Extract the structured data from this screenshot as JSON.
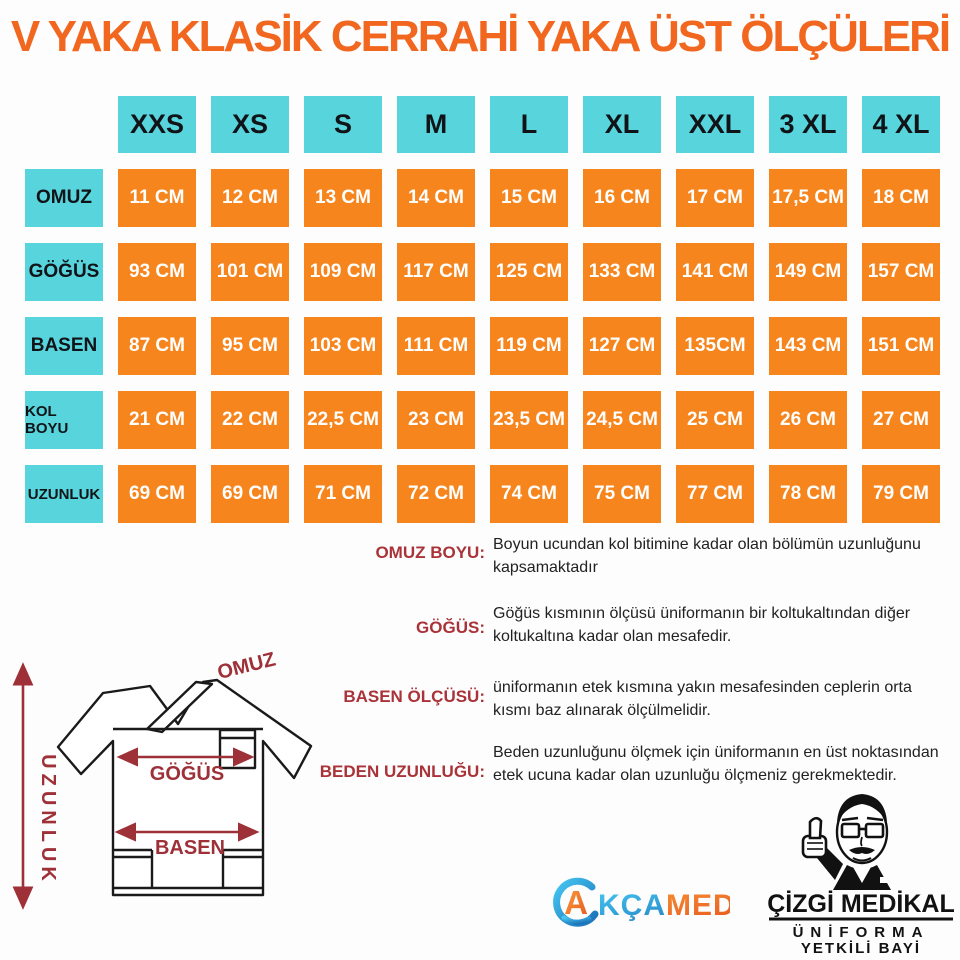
{
  "title": "V YAKA KLASİK CERRAHİ YAKA ÜST ÖLÇÜLERİ",
  "colors": {
    "title_orange": "#f2671f",
    "cell_orange": "#f6851d",
    "header_cyan": "#57d4dc",
    "label_red": "#a93338",
    "diagram_red": "#9e3038",
    "text_black": "#222222"
  },
  "size_table": {
    "columns": [
      "XXS",
      "XS",
      "S",
      "M",
      "L",
      "XL",
      "XXL",
      "3 XL",
      "4 XL"
    ],
    "rows": [
      {
        "label": "OMUZ",
        "values": [
          "11 CM",
          "12 CM",
          "13 CM",
          "14 CM",
          "15 CM",
          "16 CM",
          "17 CM",
          "17,5 CM",
          "18 CM"
        ]
      },
      {
        "label": "GÖĞÜS",
        "values": [
          "93 CM",
          "101 CM",
          "109 CM",
          "117 CM",
          "125 CM",
          "133 CM",
          "141 CM",
          "149 CM",
          "157 CM"
        ]
      },
      {
        "label": "BASEN",
        "values": [
          "87 CM",
          "95 CM",
          "103 CM",
          "111 CM",
          "119 CM",
          "127 CM",
          "135CM",
          "143 CM",
          "151 CM"
        ]
      },
      {
        "label": "KOL BOYU",
        "values": [
          "21 CM",
          "22 CM",
          "22,5 CM",
          "23 CM",
          "23,5 CM",
          "24,5 CM",
          "25 CM",
          "26 CM",
          "27 CM"
        ]
      },
      {
        "label": "UZUNLUK",
        "values": [
          "69 CM",
          "69 CM",
          "71 CM",
          "72 CM",
          "74 CM",
          "75 CM",
          "77 CM",
          "78 CM",
          "79 CM"
        ]
      }
    ]
  },
  "descriptions": [
    {
      "label": "OMUZ BOYU:",
      "text": "Boyun ucundan kol bitimine kadar olan bölümün uzunluğunu kapsamaktadır"
    },
    {
      "label": "GÖĞÜS:",
      "text": "Göğüs kısmının ölçüsü üniformanın bir koltukaltından diğer koltukaltına kadar olan mesafedir."
    },
    {
      "label": "BASEN ÖLÇÜSÜ:",
      "text": "üniformanın etek kısmına yakın mesafesinden ceplerin orta kısmı baz alınarak ölçülmelidir."
    },
    {
      "label": "BEDEN UZUNLUĞU:",
      "text": "Beden uzunluğunu ölçmek için üniformanın en üst noktasından etek ucuna kadar olan uzunluğu ölçmeniz gerekmektedir."
    }
  ],
  "diagram": {
    "omuz": "OMUZ",
    "gogus": "GÖĞÜS",
    "basen": "BASEN",
    "uzunluk": "UZUNLUK"
  },
  "logos": {
    "akcamed": {
      "icon_letter": "A",
      "text_blue": "KÇA",
      "text_orange": "MED"
    },
    "cizgi": {
      "line1": "ÇİZGİ MEDİKAL",
      "line2": "ÜNİFORMA",
      "line3": "YETKİLİ BAYİ"
    }
  }
}
